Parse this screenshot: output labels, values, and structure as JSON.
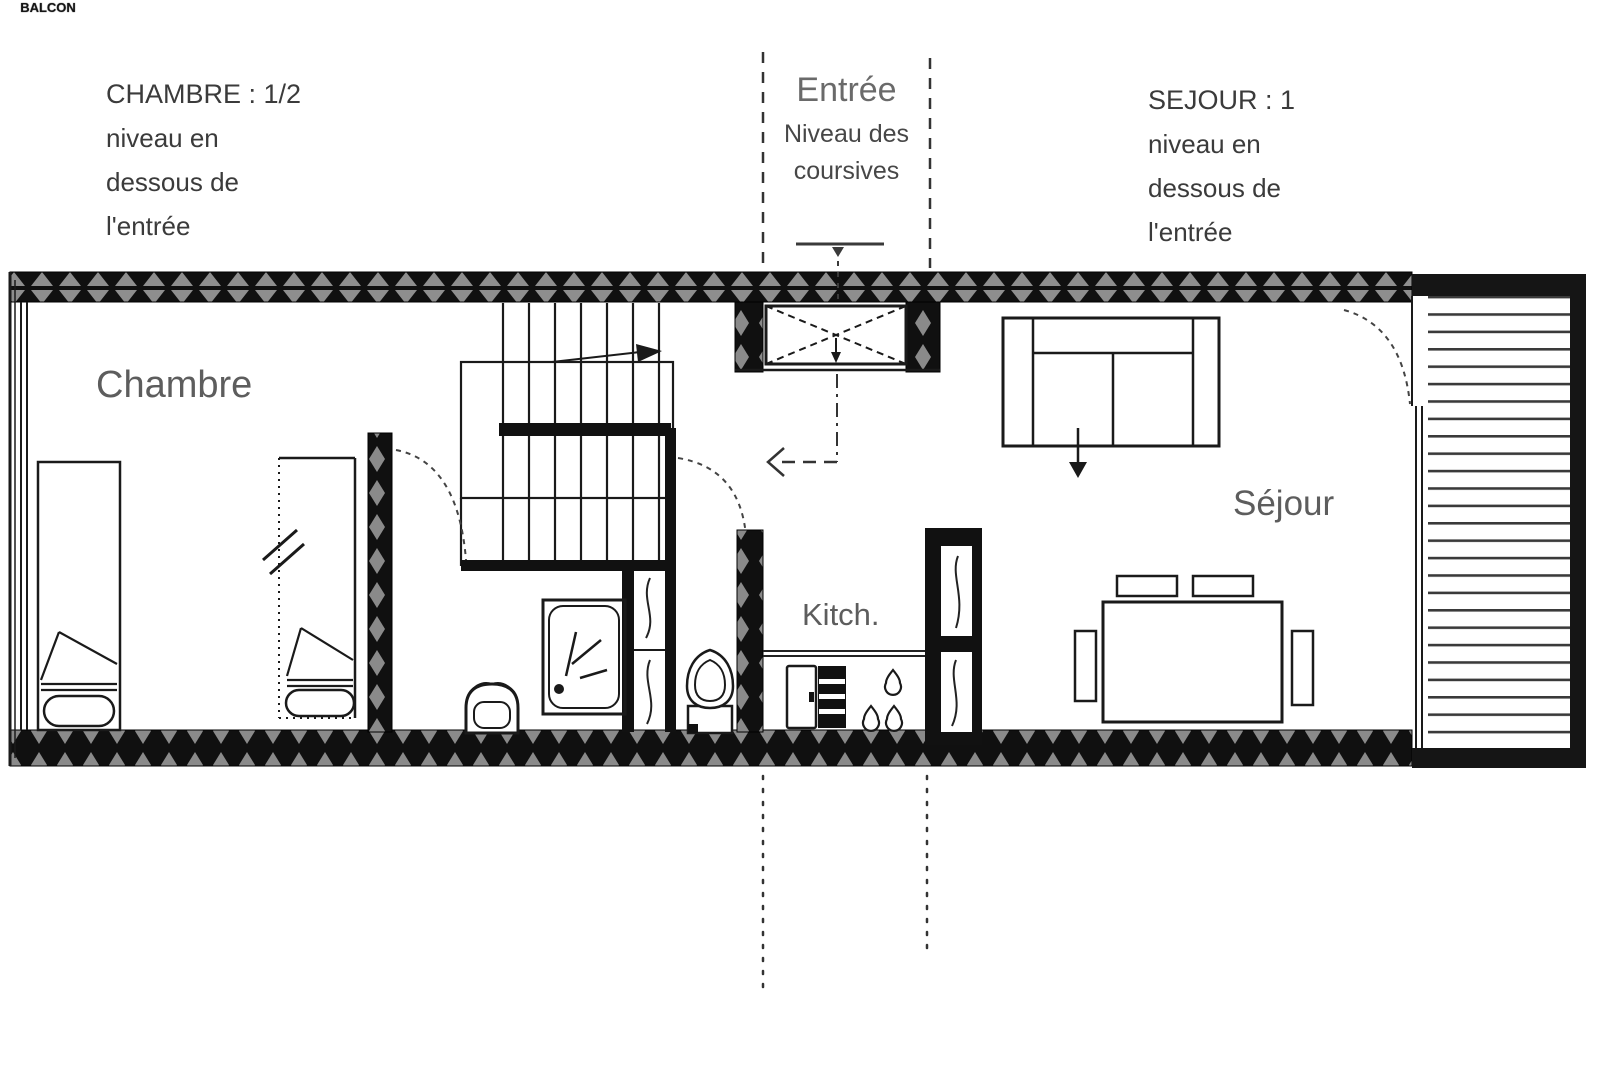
{
  "annotations": {
    "chambre_note": {
      "title": "CHAMBRE : 1/2",
      "line1": "niveau en",
      "line2": "dessous de",
      "line3": "l'entrée"
    },
    "entree_note": {
      "title": "Entrée",
      "line1": "Niveau des",
      "line2": "coursives"
    },
    "sejour_note": {
      "title": "SEJOUR : 1",
      "line1": "niveau en",
      "line2": "dessous de",
      "line3": "l'entrée"
    }
  },
  "room_labels": {
    "chambre": "Chambre",
    "sejour": "Séjour",
    "kitchen": "Kitch.",
    "balcony": "BALCON"
  },
  "colors": {
    "line": "#1a1a1a",
    "wall_fill": "#111111",
    "hatch_accent": "#8e8e8e",
    "room_label_gray": "#5d5d5d",
    "note_dark": "#3b3b3b"
  }
}
